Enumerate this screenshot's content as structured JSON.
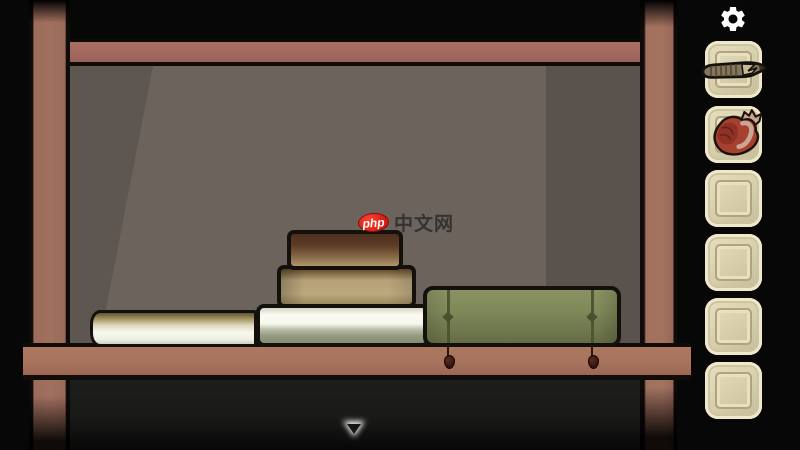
{
  "watermark": {
    "logo_text": "php",
    "site_text": "中文网"
  },
  "inventory": {
    "slots": [
      {
        "item": "cigar"
      },
      {
        "item": "heart"
      },
      {
        "item": ""
      },
      {
        "item": ""
      },
      {
        "item": ""
      },
      {
        "item": ""
      }
    ]
  },
  "scene": {
    "objects": [
      {
        "name": "white-book-left"
      },
      {
        "name": "white-book-stack-bottom"
      },
      {
        "name": "tan-book-stack-middle"
      },
      {
        "name": "brown-book-stack-top"
      },
      {
        "name": "green-strapped-book"
      }
    ]
  },
  "icons": {
    "gear": "⚙",
    "down_arrow": "▼"
  },
  "colors": {
    "slot_bg": "#d8cfad",
    "wood_frame": "#a1705f",
    "shelf": "#a8735f",
    "wall": "#6c635d",
    "green_book": "#7f8859",
    "logo_red": "#d51a10",
    "under_shelf": "#1b1b19",
    "background": "#070707"
  }
}
